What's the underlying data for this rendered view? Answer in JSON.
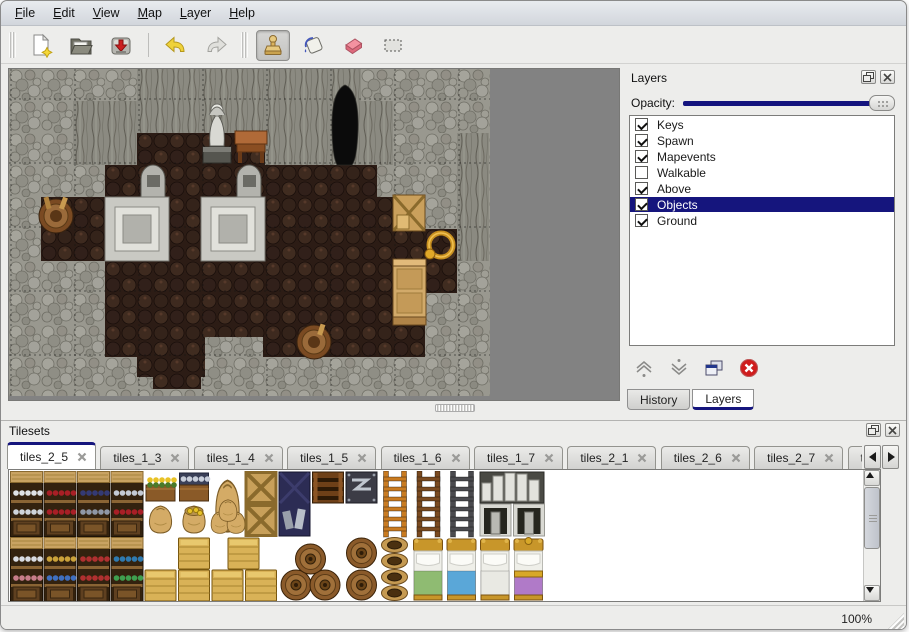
{
  "accent": {
    "selection_navy": "#15157d",
    "slider_navy": "#14147e"
  },
  "menu": {
    "items": [
      {
        "label": "File"
      },
      {
        "label": "Edit"
      },
      {
        "label": "View"
      },
      {
        "label": "Map"
      },
      {
        "label": "Layer"
      },
      {
        "label": "Help"
      }
    ]
  },
  "toolbar": {
    "icons": [
      "new-file",
      "open-folder",
      "save",
      "undo",
      "redo",
      "stamp-tool",
      "fill-tool",
      "eraser-tool",
      "rect-select-tool"
    ],
    "active_tool": "stamp-tool"
  },
  "layers_panel": {
    "title": "Layers",
    "opacity_label": "Opacity:",
    "opacity_fraction": 1,
    "layers": [
      {
        "name": "Keys",
        "checked": true,
        "selected": false
      },
      {
        "name": "Spawn",
        "checked": true,
        "selected": false
      },
      {
        "name": "Mapevents",
        "checked": true,
        "selected": false
      },
      {
        "name": "Walkable",
        "checked": false,
        "selected": false
      },
      {
        "name": "Above",
        "checked": true,
        "selected": false
      },
      {
        "name": "Objects",
        "checked": true,
        "selected": true
      },
      {
        "name": "Ground",
        "checked": true,
        "selected": false
      }
    ],
    "tools": [
      "raise-layer",
      "lower-layer",
      "duplicate-layer",
      "delete-layer"
    ],
    "bottom_tabs": [
      {
        "label": "History",
        "active": false
      },
      {
        "label": "Layers",
        "active": true
      }
    ]
  },
  "tilesets_panel": {
    "title": "Tilesets",
    "tabs": [
      {
        "label": "tiles_2_5",
        "active": true
      },
      {
        "label": "tiles_1_3",
        "active": false
      },
      {
        "label": "tiles_1_4",
        "active": false
      },
      {
        "label": "tiles_1_5",
        "active": false
      },
      {
        "label": "tiles_1_6",
        "active": false
      },
      {
        "label": "tiles_1_7",
        "active": false
      },
      {
        "label": "tiles_2_1",
        "active": false
      },
      {
        "label": "tiles_2_6",
        "active": false
      },
      {
        "label": "tiles_2_7",
        "active": false
      },
      {
        "label": "tiles_",
        "active": false
      }
    ]
  },
  "statusbar": {
    "zoom_level": "100%"
  }
}
